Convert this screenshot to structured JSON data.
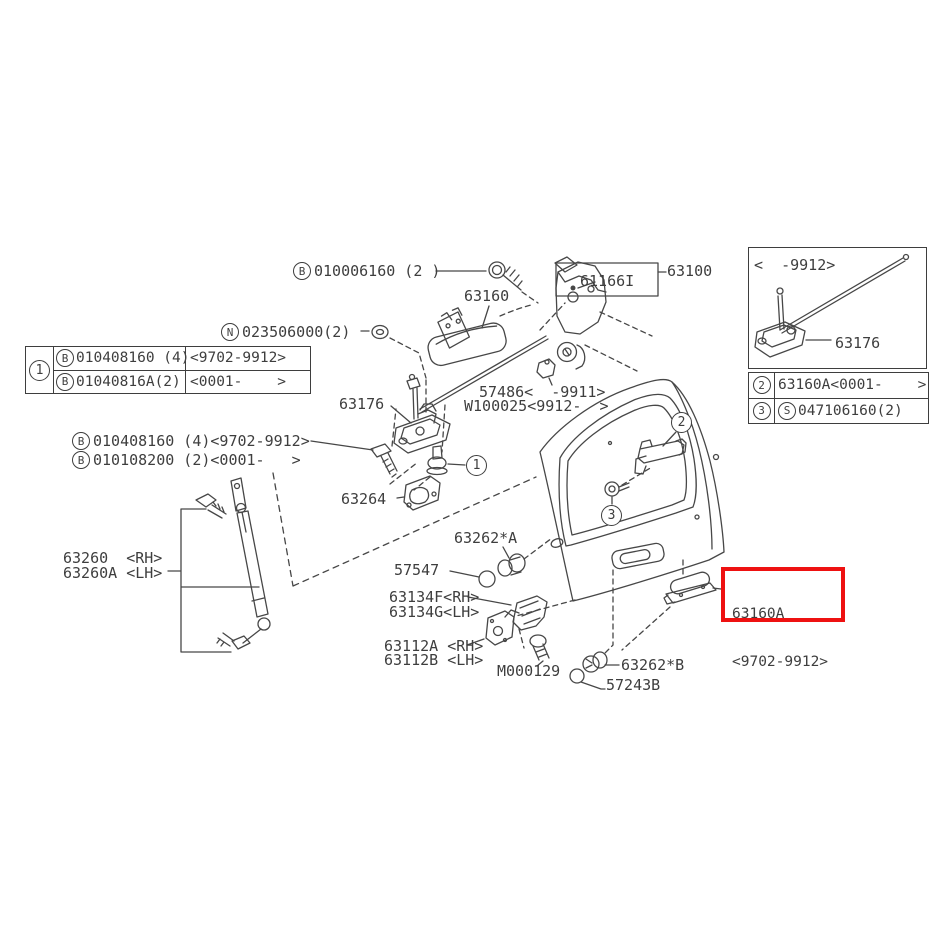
{
  "labels": {
    "b010006160": {
      "prefix": "B",
      "text": "010006160 (2 )"
    },
    "n023506000": {
      "prefix": "N",
      "text": "023506000(2)"
    },
    "p63160": "63160",
    "p61166i": "61166I",
    "p63100": "63100",
    "p63176": "63176",
    "p57486": "57486<  -9911>",
    "pw100025": "W100025<9912-  >",
    "b010408160": {
      "prefix": "B",
      "text": "010408160 (4)<9702-9912>"
    },
    "b010108200": {
      "prefix": "B",
      "text": "010108200 (2)<0001-   >"
    },
    "p63264": "63264",
    "p63260rh": "63260  <RH>",
    "p63260lh": "63260A <LH>",
    "p63262a": "63262*A",
    "p57547": "57547",
    "p63134f": "63134F<RH>",
    "p63134g": "63134G<LH>",
    "p63112a": "63112A <RH>",
    "p63112b": "63112B <LH>",
    "pm000129": "M000129",
    "p63262b": "63262*B",
    "p57243b": "57243B"
  },
  "callouts": {
    "c1": "1",
    "c2": "2",
    "c3": "3"
  },
  "note_table_1": {
    "marker": "1",
    "rows": [
      {
        "prefix": "B",
        "part": "010408160 (4)",
        "range": "<9702-9912>"
      },
      {
        "prefix": "B",
        "part": "01040816A(2)",
        "range": "<0001-    >"
      }
    ]
  },
  "inset_box": {
    "range": "<  -9912>",
    "part": "63176"
  },
  "note_table_2": {
    "rows": [
      {
        "marker": "2",
        "part": "63160A<0001-    >"
      },
      {
        "marker": "3",
        "prefix": "S",
        "part": "047106160(2)"
      }
    ]
  },
  "highlight_box": {
    "line1": "63160A",
    "line2": "<9702-9912>"
  },
  "colors": {
    "line": "#474747",
    "highlight": "#ee1111"
  }
}
